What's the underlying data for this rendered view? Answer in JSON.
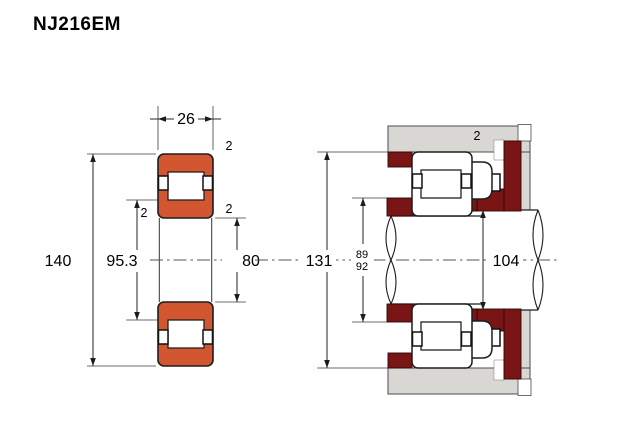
{
  "title": "NJ216EM",
  "colors": {
    "bearing_orange": "#d2562f",
    "abutment_maroon": "#7a1516",
    "housing_gray": "#d9d7d3"
  },
  "left_view": {
    "width": "26",
    "outer_diameter": "140",
    "rib_diameter": "95.3",
    "bore_diameter": "80",
    "outer_chamfer": "2",
    "inner_chamfer_left": "2",
    "inner_chamfer_right": "2"
  },
  "right_view": {
    "housing_abutment_diameter": "131",
    "shaft_abutment_diameter_upper": "89",
    "shaft_abutment_diameter_lower": "92",
    "shaft_diameter": "104",
    "housing_chamfer": "2"
  }
}
